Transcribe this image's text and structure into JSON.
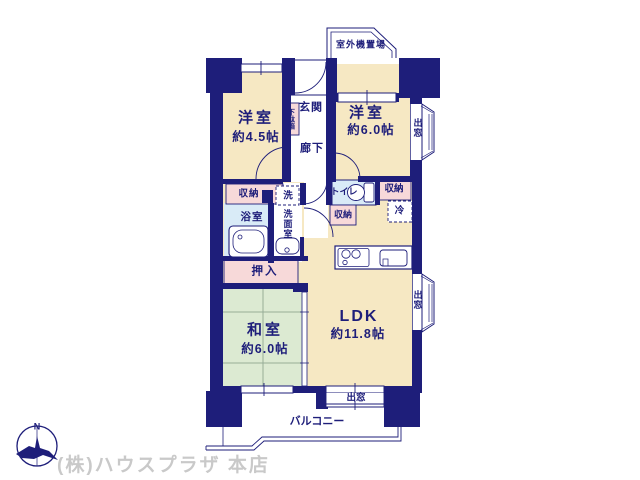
{
  "plan": {
    "rooms": {
      "western1": {
        "name": "洋室",
        "size": "約4.5帖"
      },
      "western2": {
        "name": "洋室",
        "size": "約6.0帖"
      },
      "japanese": {
        "name": "和室",
        "size": "約6.0帖"
      },
      "ldk": {
        "name": "LDK",
        "size": "約11.8帖"
      }
    },
    "labels": {
      "outdoor_unit": "室外機置場",
      "entrance": "玄関",
      "shoe_cabinet": "下駄箱",
      "hallway": "廊下",
      "storage_1": "収納",
      "storage_2": "収納",
      "storage_3": "収納",
      "bathroom": "浴室",
      "laundry": "洗",
      "washroom": "洗面室",
      "toilet": "トイレ",
      "refrigerator": "冷",
      "closet": "押入",
      "bay_window_1": "出窓",
      "bay_window_2": "出窓",
      "bay_window_3": "出窓",
      "balcony": "バルコニー"
    },
    "compass": {
      "north": "N"
    },
    "watermark": "(株)ハウスプラザ 本店"
  },
  "colors": {
    "wall": "#1e1e7a",
    "floor": "#f6e8c3",
    "tatami": "#dcead2",
    "wet_area": "#d9ebf7",
    "storage": "#f7d9d9",
    "watermark": "#c9c9c9",
    "background": "#ffffff"
  }
}
